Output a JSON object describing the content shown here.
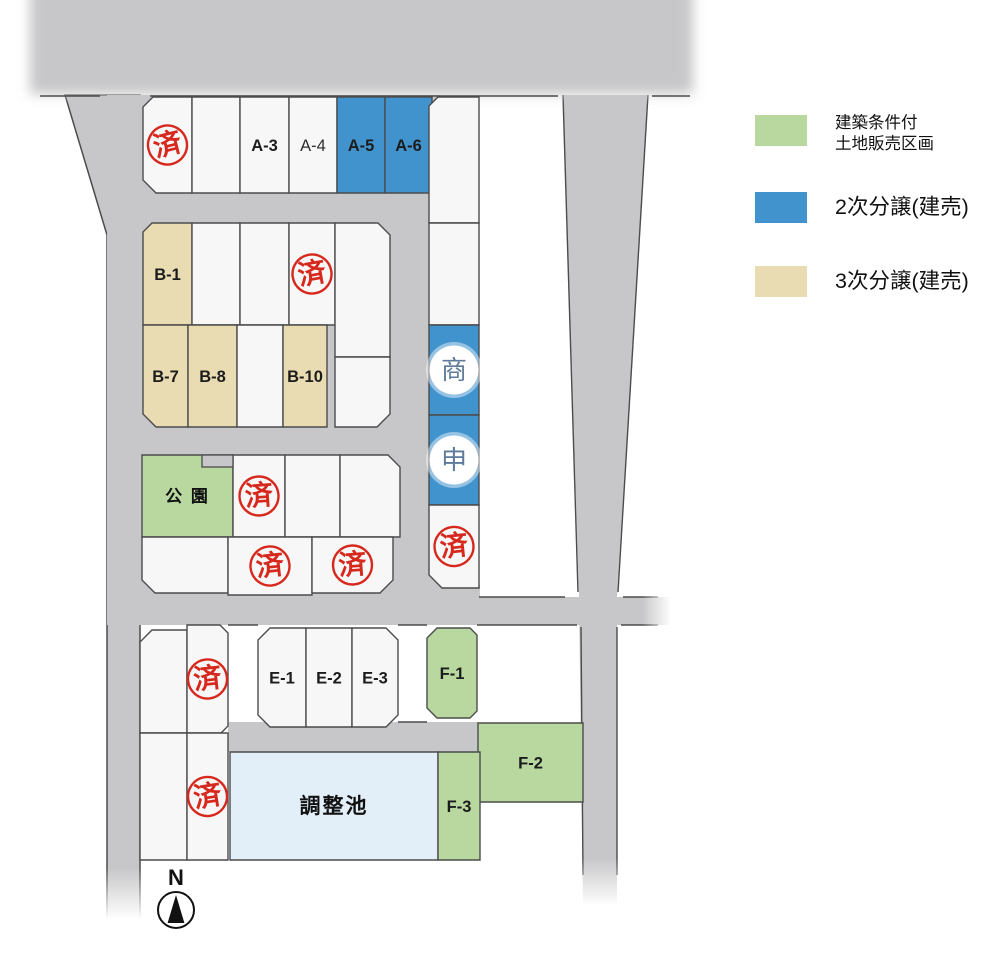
{
  "colors": {
    "road": "#c7c7c9",
    "lot": "#f7f7f7",
    "blue": "#4193ce",
    "tan": "#e9dbb2",
    "green": "#b8d8a0",
    "pond": "#e2eef8",
    "border": "#4c4c4c",
    "stamp": "#d7281d",
    "mark": "#5e7b99"
  },
  "legend": {
    "items": [
      {
        "color_key": "green",
        "lines": [
          "建築条件付",
          "土地販売区画"
        ]
      },
      {
        "color_key": "blue",
        "lines": [
          "2次分譲(建売)"
        ]
      },
      {
        "color_key": "tan",
        "lines": [
          "3次分譲(建売)"
        ]
      }
    ]
  },
  "compass": {
    "label": "N"
  },
  "map": {
    "band": {
      "x": 30,
      "y": -40,
      "w": 663,
      "h": 134
    },
    "band_lines": "M40,96 L100,96 M150,96 L558,96 M652,96 L690,96",
    "roads": [
      {
        "shape": "poly",
        "pts": "65,95 140,95 140,925 107,925 107,235",
        "stroke": true,
        "name": "road-left"
      },
      {
        "shape": "rect",
        "x": 107,
        "y": 95,
        "w": 333,
        "h": 530,
        "name": "road-inner-backdrop"
      },
      {
        "shape": "rect",
        "x": 140,
        "y": 597,
        "w": 535,
        "h": 28,
        "name": "road-middle"
      },
      {
        "shape": "rect",
        "x": 428,
        "y": 585,
        "w": 52,
        "h": 14,
        "name": "road-patch"
      },
      {
        "shape": "poly",
        "pts": "563,95 648,95 617,597 617,905 583,905 579,597",
        "name": "road-right"
      },
      {
        "shape": "rect",
        "x": 228,
        "y": 722,
        "w": 250,
        "h": 30,
        "name": "road-lower"
      }
    ],
    "edge_paths": [
      "M563,95 L578,592",
      "M581,627 L583,875",
      "M648,95 L618,592",
      "M617,627 L617,875",
      "M479,597 L565,597",
      "M623,597 L658,597",
      "M228,625 L258,625",
      "M398,625 L427,625",
      "M477,625 L577,625",
      "M621,625 L658,625",
      "M398,722 L427,722"
    ],
    "park_notch": {
      "x": 202,
      "y": 455,
      "w": 31,
      "h": 12
    },
    "fades": [
      {
        "x": 98,
        "y": 868,
        "w": 46,
        "h": 64,
        "dir": "v"
      },
      {
        "x": 576,
        "y": 858,
        "w": 46,
        "h": 60,
        "dir": "v"
      },
      {
        "x": 642,
        "y": 590,
        "w": 36,
        "h": 40,
        "dir": "h"
      }
    ],
    "lots": [
      {
        "id": "lot-a-sold",
        "x": 143,
        "y": 97,
        "w": 49,
        "h": 96,
        "cut": {
          "tl": 10,
          "bl": 13
        },
        "stamp": "済",
        "rot": -14
      },
      {
        "id": "lot-a2",
        "x": 192,
        "y": 97,
        "w": 48,
        "h": 96
      },
      {
        "id": "lot-a3",
        "x": 240,
        "y": 97,
        "w": 49,
        "h": 96,
        "label": "A-3"
      },
      {
        "id": "lot-a4",
        "x": 289,
        "y": 97,
        "w": 48,
        "h": 96,
        "label": "A-4",
        "light": true
      },
      {
        "id": "lot-a5",
        "x": 337,
        "y": 97,
        "w": 48,
        "h": 96,
        "t": "blue",
        "label": "A-5"
      },
      {
        "id": "lot-a6",
        "x": 385,
        "y": 97,
        "w": 47,
        "h": 96,
        "t": "blue",
        "label": "A-6"
      },
      {
        "id": "lot-s1",
        "x": 429,
        "y": 97,
        "w": 50,
        "h": 126,
        "cut": {
          "tl": 9
        }
      },
      {
        "id": "lot-s2",
        "x": 429,
        "y": 223,
        "w": 50,
        "h": 102
      },
      {
        "id": "lot-s3",
        "x": 429,
        "y": 325,
        "w": 50,
        "h": 90,
        "t": "blue",
        "circle": "商"
      },
      {
        "id": "lot-s4",
        "x": 429,
        "y": 415,
        "w": 50,
        "h": 90,
        "t": "blue",
        "circle": "申"
      },
      {
        "id": "lot-s5",
        "x": 429,
        "y": 505,
        "w": 50,
        "h": 83,
        "cut": {
          "bl": 13
        },
        "stamp": "済",
        "rot": -6
      },
      {
        "id": "lot-b1",
        "x": 143,
        "y": 223,
        "w": 49,
        "h": 102,
        "t": "tan",
        "label": "B-1",
        "cut": {
          "tl": 9
        }
      },
      {
        "id": "lot-b2",
        "x": 192,
        "y": 223,
        "w": 48,
        "h": 102
      },
      {
        "id": "lot-b3",
        "x": 240,
        "y": 223,
        "w": 49,
        "h": 102
      },
      {
        "id": "lot-b4",
        "x": 289,
        "y": 223,
        "w": 46,
        "h": 102,
        "stamp": "済",
        "rot": -10
      },
      {
        "id": "lot-b5",
        "x": 335,
        "y": 223,
        "w": 55,
        "h": 134,
        "cut": {
          "tr": 12
        }
      },
      {
        "id": "lot-b6",
        "x": 335,
        "y": 357,
        "w": 55,
        "h": 70,
        "cut": {
          "br": 13
        }
      },
      {
        "id": "lot-b7",
        "x": 143,
        "y": 325,
        "w": 45,
        "h": 102,
        "t": "tan",
        "label": "B-7",
        "cut": {
          "bl": 13
        }
      },
      {
        "id": "lot-b8",
        "x": 188,
        "y": 325,
        "w": 49,
        "h": 102,
        "t": "tan",
        "label": "B-8"
      },
      {
        "id": "lot-b9",
        "x": 237,
        "y": 325,
        "w": 46,
        "h": 102
      },
      {
        "id": "lot-b10",
        "x": 283,
        "y": 325,
        "w": 44,
        "h": 102,
        "t": "tan",
        "label": "B-10"
      },
      {
        "id": "lot-park",
        "x": 142,
        "y": 455,
        "w": 91,
        "h": 82,
        "t": "green",
        "label": "公 園",
        "cls": "park"
      },
      {
        "id": "lot-c1",
        "x": 233,
        "y": 455,
        "w": 52,
        "h": 82,
        "stamp": "済",
        "rot": -4
      },
      {
        "id": "lot-c2",
        "x": 285,
        "y": 455,
        "w": 55,
        "h": 82
      },
      {
        "id": "lot-c3",
        "x": 340,
        "y": 455,
        "w": 60,
        "h": 82,
        "cut": {
          "tr": 12
        }
      },
      {
        "id": "lot-c4",
        "x": 142,
        "y": 537,
        "w": 86,
        "h": 56,
        "cut": {
          "bl": 13
        }
      },
      {
        "id": "lot-c5",
        "x": 228,
        "y": 537,
        "w": 84,
        "h": 58,
        "stamp": "済",
        "rot": -6
      },
      {
        "id": "lot-c6",
        "x": 312,
        "y": 537,
        "w": 81,
        "h": 56,
        "cut": {
          "br": 13
        },
        "stamp": "済",
        "rot": -4
      },
      {
        "id": "lot-l1",
        "x": 140,
        "y": 630,
        "w": 47,
        "h": 103,
        "cut": {
          "tl": 12
        }
      },
      {
        "id": "lot-l2",
        "x": 187,
        "y": 625,
        "w": 41,
        "h": 108,
        "cut": {
          "tr": 8,
          "br": 7
        },
        "stamp": "済",
        "rot": -6
      },
      {
        "id": "lot-l3",
        "x": 140,
        "y": 733,
        "w": 47,
        "h": 127
      },
      {
        "id": "lot-l4",
        "x": 187,
        "y": 733,
        "w": 41,
        "h": 127,
        "stamp": "済",
        "rot": -9
      },
      {
        "id": "lot-e1",
        "x": 258,
        "y": 628,
        "w": 48,
        "h": 99,
        "label": "E-1",
        "cut": {
          "tl": 12,
          "bl": 12
        }
      },
      {
        "id": "lot-e2",
        "x": 306,
        "y": 628,
        "w": 46,
        "h": 99,
        "label": "E-2"
      },
      {
        "id": "lot-e3",
        "x": 352,
        "y": 628,
        "w": 46,
        "h": 99,
        "label": "E-3",
        "cut": {
          "tr": 12,
          "br": 12
        }
      },
      {
        "id": "lot-f1",
        "x": 427,
        "y": 628,
        "w": 50,
        "h": 90,
        "t": "green",
        "label": "F-1",
        "cut": {
          "tl": 10,
          "tr": 7,
          "bl": 10,
          "br": 7
        }
      },
      {
        "id": "lot-f2",
        "x": 478,
        "y": 723,
        "w": 105,
        "h": 79,
        "t": "green",
        "label": "F-2"
      },
      {
        "id": "pond",
        "x": 230,
        "y": 752,
        "w": 208,
        "h": 108,
        "t": "pond",
        "label": "調整池",
        "cls": "pond"
      },
      {
        "id": "lot-f3",
        "x": 438,
        "y": 752,
        "w": 42,
        "h": 108,
        "t": "green",
        "label": "F-3"
      }
    ]
  }
}
